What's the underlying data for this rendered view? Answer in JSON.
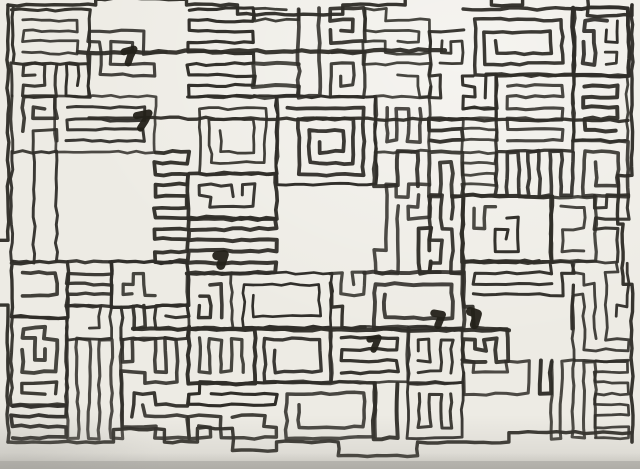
{
  "artwork": {
    "description": "Dense hand-drawn rectilinear maze drawing, black marker ink on off-white paper, photographed with soft gray shadow along the bottom edge",
    "paper_color": "#edebe4",
    "ink_color": "#2f2d28",
    "heavy_ink_color": "#232119",
    "shadow_color": "#8f8d88",
    "edge_band_color": "#a3a19b",
    "highlight_color": "#ffffff",
    "seed": 20,
    "cell_size": 11,
    "stroke_width_min": 2.6,
    "stroke_width_max": 4.0,
    "canvas": {
      "width": 640,
      "height": 469
    }
  }
}
